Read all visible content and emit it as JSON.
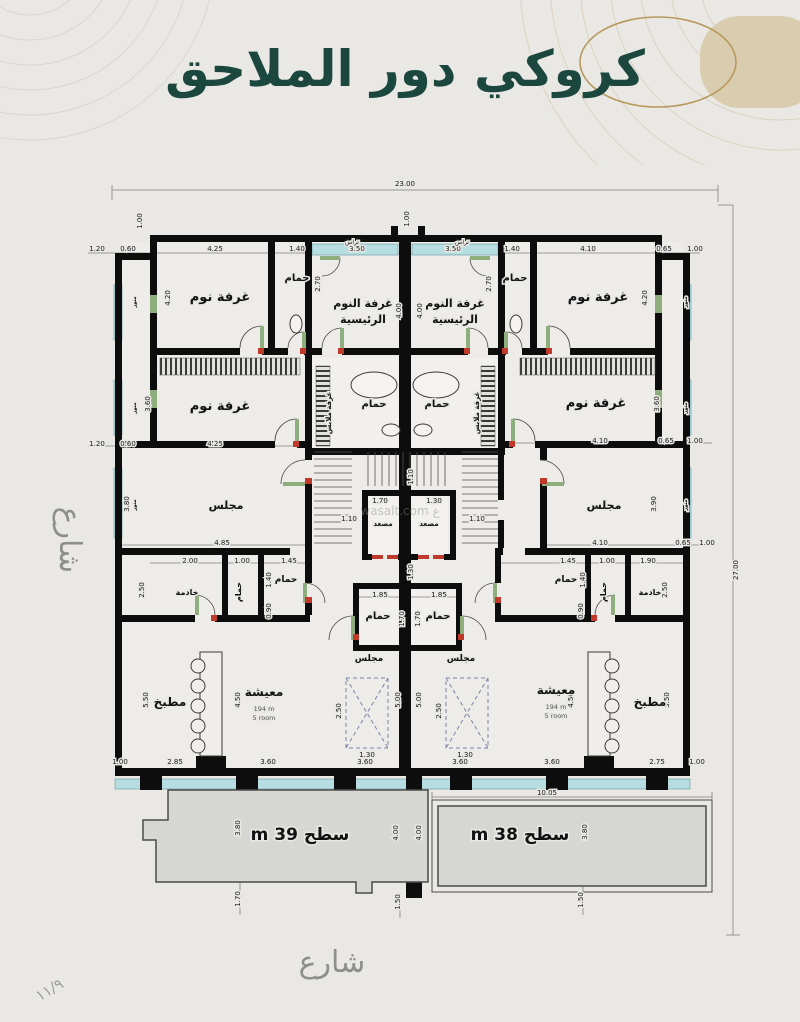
{
  "page": {
    "title": "كروكي دور الملاحق",
    "street_left": "شارع",
    "street_bottom": "شارع",
    "page_number": "١١/٩",
    "watermark": "wasalt.com ع"
  },
  "colors": {
    "title": "#1c473f",
    "gold": "#b8995c",
    "glazing": "#b7dde2",
    "wall": "#0d0d0d",
    "terrace_fill": "#d6d6d3",
    "street_text": "#8e8e8a",
    "door_mark": "#c0392b"
  },
  "plan": {
    "overall": {
      "width_m": "23.00",
      "height_m": "27.00"
    },
    "units": {
      "left_roof_label": "سطح 39 m",
      "right_roof_label": "سطح 38 m",
      "living_area": "194 m",
      "living_rooms": "5 room"
    },
    "labels": [
      {
        "n": "label-bedroom-1-left",
        "t": "غرفة نوم",
        "x": 220,
        "y": 301,
        "s": 13,
        "b": 1
      },
      {
        "n": "label-bath-top-left",
        "t": "حمام",
        "x": 297,
        "y": 281,
        "s": 10,
        "b": 1
      },
      {
        "n": "label-master-bedroom-left",
        "x": 363,
        "y": 307,
        "s": 11,
        "b": 1,
        "lines": [
          {
            "t": "غرفة النوم",
            "dy": 0
          },
          {
            "t": "الرئيسية",
            "dy": 16
          }
        ]
      },
      {
        "n": "label-master-bedroom-right",
        "x": 455,
        "y": 307,
        "s": 11,
        "b": 1,
        "lines": [
          {
            "t": "غرفة النوم",
            "dy": 0
          },
          {
            "t": "الرئيسية",
            "dy": 16
          }
        ]
      },
      {
        "n": "label-bath-top-right",
        "t": "حمام",
        "x": 515,
        "y": 281,
        "s": 10,
        "b": 1
      },
      {
        "n": "label-bedroom-1-right",
        "t": "غرفة نوم",
        "x": 598,
        "y": 301,
        "s": 13,
        "b": 1
      },
      {
        "n": "label-bedroom-2-left",
        "t": "غرفة نوم",
        "x": 220,
        "y": 410,
        "s": 13,
        "b": 1
      },
      {
        "n": "label-bedroom-2-right",
        "t": "غرفة نوم",
        "x": 596,
        "y": 407,
        "s": 13,
        "b": 1
      },
      {
        "n": "label-dressing-left",
        "t": "غرفة ملابس",
        "x": 331,
        "y": 413,
        "s": 7,
        "b": 1,
        "r": -90
      },
      {
        "n": "label-dressing-right",
        "t": "غرفة ملابس",
        "x": 479,
        "y": 413,
        "s": 7,
        "b": 1,
        "r": -90
      },
      {
        "n": "label-bath-mid-left",
        "t": "حمام",
        "x": 374,
        "y": 407,
        "s": 10,
        "b": 1
      },
      {
        "n": "label-bath-mid-right",
        "t": "حمام",
        "x": 437,
        "y": 407,
        "s": 10,
        "b": 1
      },
      {
        "n": "label-majlis-left",
        "t": "مجلس",
        "x": 226,
        "y": 509,
        "s": 11,
        "b": 1
      },
      {
        "n": "label-majlis-right",
        "t": "مجلس",
        "x": 604,
        "y": 509,
        "s": 11,
        "b": 1
      },
      {
        "n": "label-elevator-left",
        "t": "مصعد",
        "x": 383,
        "y": 526,
        "s": 7,
        "b": 1
      },
      {
        "n": "label-elevator-right",
        "t": "مصعد",
        "x": 429,
        "y": 526,
        "s": 7,
        "b": 1
      },
      {
        "n": "label-maid-left",
        "t": "خادمة",
        "x": 187,
        "y": 595,
        "s": 8,
        "b": 1
      },
      {
        "n": "label-bath-d1-left",
        "t": "حمام",
        "x": 241,
        "y": 592,
        "s": 8,
        "b": 1,
        "r": -90
      },
      {
        "n": "label-bath-d2-left",
        "t": "حمام",
        "x": 286,
        "y": 582,
        "s": 9,
        "b": 1
      },
      {
        "n": "label-bath-d1-right",
        "t": "حمام",
        "x": 566,
        "y": 582,
        "s": 9,
        "b": 1
      },
      {
        "n": "label-bath-d2-right",
        "t": "حمام",
        "x": 606,
        "y": 592,
        "s": 8,
        "b": 1,
        "r": -90
      },
      {
        "n": "label-maid-right",
        "t": "خادمة",
        "x": 650,
        "y": 595,
        "s": 8,
        "b": 1
      },
      {
        "n": "label-bath-center-left",
        "t": "حمام",
        "x": 378,
        "y": 619,
        "s": 10,
        "b": 1
      },
      {
        "n": "label-bath-center-right",
        "t": "حمام",
        "x": 438,
        "y": 619,
        "s": 10,
        "b": 1
      },
      {
        "n": "label-majlis-small-left",
        "t": "مجلس",
        "x": 369,
        "y": 661,
        "s": 9,
        "b": 1
      },
      {
        "n": "label-majlis-small-right",
        "t": "مجلس",
        "x": 461,
        "y": 661,
        "s": 9,
        "b": 1
      },
      {
        "n": "label-living-left",
        "x": 264,
        "y": 696,
        "s": 12,
        "b": 1,
        "lines": [
          {
            "t": "معيشة",
            "dy": 0
          },
          {
            "t": "194 m",
            "dy": 15,
            "s": 6.5,
            "b": 0,
            "c": "#555553"
          },
          {
            "t": "5 room",
            "dy": 24,
            "s": 6.5,
            "b": 0,
            "c": "#555553"
          }
        ]
      },
      {
        "n": "label-living-right",
        "x": 556,
        "y": 694,
        "s": 12,
        "b": 1,
        "lines": [
          {
            "t": "معيشة",
            "dy": 0
          },
          {
            "t": "194 m",
            "dy": 15,
            "s": 6.5,
            "b": 0,
            "c": "#555553"
          },
          {
            "t": "5 room",
            "dy": 24,
            "s": 6.5,
            "b": 0,
            "c": "#555553"
          }
        ]
      },
      {
        "n": "label-kitchen-left",
        "t": "مطبخ",
        "x": 170,
        "y": 706,
        "s": 12,
        "b": 1
      },
      {
        "n": "label-kitchen-right",
        "t": "مطبخ",
        "x": 650,
        "y": 706,
        "s": 12,
        "b": 1
      },
      {
        "n": "label-roof-left",
        "t": "سطح 39 m",
        "x": 300,
        "y": 840,
        "s": 17,
        "b": 1,
        "rtl": 1
      },
      {
        "n": "label-roof-right",
        "t": "سطح 38 m",
        "x": 520,
        "y": 840,
        "s": 17,
        "b": 1,
        "rtl": 1
      },
      {
        "n": "label-balcony-left",
        "t": "تراس",
        "x": 352,
        "y": 244,
        "s": 6
      },
      {
        "n": "label-balcony-right",
        "t": "تراس",
        "x": 462,
        "y": 244,
        "s": 6
      },
      {
        "n": "label-lightwell-left-1",
        "t": "منور",
        "x": 136,
        "y": 302,
        "s": 5,
        "b": 1,
        "r": -90
      },
      {
        "n": "label-lightwell-left-2",
        "t": "منور",
        "x": 136,
        "y": 408,
        "s": 5,
        "b": 1,
        "r": -90
      },
      {
        "n": "label-lightwell-left-3",
        "t": "منور",
        "x": 136,
        "y": 505,
        "s": 5,
        "b": 1,
        "r": -90
      },
      {
        "n": "label-lightwell-right-1",
        "t": "منور",
        "x": 687,
        "y": 302,
        "s": 5,
        "b": 1,
        "r": -90
      },
      {
        "n": "label-lightwell-right-2",
        "t": "منور",
        "x": 687,
        "y": 408,
        "s": 5,
        "b": 1,
        "r": -90
      },
      {
        "n": "label-lightwell-right-3",
        "t": "منور",
        "x": 687,
        "y": 505,
        "s": 5,
        "b": 1,
        "r": -90
      }
    ],
    "dims": [
      {
        "t": "23.00",
        "x": 405,
        "y": 186
      },
      {
        "t": "27.00",
        "x": 738,
        "y": 570,
        "r": 1
      },
      {
        "t": "1.20",
        "x": 97,
        "y": 251
      },
      {
        "t": "0.60",
        "x": 128,
        "y": 251
      },
      {
        "t": "4.25",
        "x": 215,
        "y": 251
      },
      {
        "t": "1.40",
        "x": 297,
        "y": 251
      },
      {
        "t": "3.50",
        "x": 357,
        "y": 251
      },
      {
        "t": "3.50",
        "x": 453,
        "y": 251
      },
      {
        "t": "1.40",
        "x": 512,
        "y": 251
      },
      {
        "t": "4.10",
        "x": 588,
        "y": 251
      },
      {
        "t": "0.65",
        "x": 664,
        "y": 251
      },
      {
        "t": "1.00",
        "x": 695,
        "y": 251
      },
      {
        "t": "1.00",
        "x": 409,
        "y": 219,
        "r": 1
      },
      {
        "t": "1.00",
        "x": 142,
        "y": 221,
        "r": 1
      },
      {
        "t": "4.20",
        "x": 170,
        "y": 298,
        "r": 1
      },
      {
        "t": "2.70",
        "x": 320,
        "y": 284,
        "r": 1
      },
      {
        "t": "4.00",
        "x": 401,
        "y": 311,
        "r": 1
      },
      {
        "t": "4.00",
        "x": 422,
        "y": 311,
        "r": 1
      },
      {
        "t": "2.70",
        "x": 491,
        "y": 284,
        "r": 1
      },
      {
        "t": "4.20",
        "x": 647,
        "y": 298,
        "r": 1
      },
      {
        "t": "3.60",
        "x": 150,
        "y": 404,
        "r": 1
      },
      {
        "t": "3.60",
        "x": 659,
        "y": 404,
        "r": 1
      },
      {
        "t": "1.20",
        "x": 97,
        "y": 446
      },
      {
        "t": "0.60",
        "x": 128,
        "y": 446
      },
      {
        "t": "4.25",
        "x": 215,
        "y": 446
      },
      {
        "t": "4.10",
        "x": 600,
        "y": 443
      },
      {
        "t": "0.65",
        "x": 666,
        "y": 443
      },
      {
        "t": "1.00",
        "x": 695,
        "y": 443
      },
      {
        "t": "4.85",
        "x": 222,
        "y": 545
      },
      {
        "t": "4.10",
        "x": 600,
        "y": 545
      },
      {
        "t": "0.65",
        "x": 683,
        "y": 545
      },
      {
        "t": "1.00",
        "x": 707,
        "y": 545
      },
      {
        "t": "3.80",
        "x": 129,
        "y": 504,
        "r": 1
      },
      {
        "t": "3.90",
        "x": 656,
        "y": 504,
        "r": 1
      },
      {
        "t": "1.70",
        "x": 380,
        "y": 503
      },
      {
        "t": "1.30",
        "x": 434,
        "y": 503
      },
      {
        "t": "1.10",
        "x": 349,
        "y": 521
      },
      {
        "t": "1.10",
        "x": 477,
        "y": 521
      },
      {
        "t": "1.10",
        "x": 413,
        "y": 477,
        "r": 1
      },
      {
        "t": "2.00",
        "x": 190,
        "y": 563
      },
      {
        "t": "1.00",
        "x": 242,
        "y": 563
      },
      {
        "t": "1.45",
        "x": 289,
        "y": 563
      },
      {
        "t": "1.45",
        "x": 568,
        "y": 563
      },
      {
        "t": "1.00",
        "x": 607,
        "y": 563
      },
      {
        "t": "1.90",
        "x": 648,
        "y": 563
      },
      {
        "t": "2.50",
        "x": 144,
        "y": 590,
        "r": 1
      },
      {
        "t": "1.40",
        "x": 271,
        "y": 580,
        "r": 1
      },
      {
        "t": "0.90",
        "x": 271,
        "y": 611,
        "r": 1
      },
      {
        "t": "1.40",
        "x": 585,
        "y": 580,
        "r": 1
      },
      {
        "t": "0.90",
        "x": 583,
        "y": 611,
        "r": 1
      },
      {
        "t": "2.50",
        "x": 667,
        "y": 590,
        "r": 1
      },
      {
        "t": "1.30",
        "x": 413,
        "y": 572,
        "r": 1
      },
      {
        "t": "1.85",
        "x": 380,
        "y": 597
      },
      {
        "t": "1.85",
        "x": 439,
        "y": 597
      },
      {
        "t": "1.70",
        "x": 404,
        "y": 619,
        "r": 1
      },
      {
        "t": "1.70",
        "x": 420,
        "y": 619,
        "r": 1
      },
      {
        "t": "2.50",
        "x": 341,
        "y": 711,
        "r": 1
      },
      {
        "t": "1.30",
        "x": 367,
        "y": 757
      },
      {
        "t": "2.50",
        "x": 441,
        "y": 711,
        "r": 1
      },
      {
        "t": "1.30",
        "x": 465,
        "y": 757
      },
      {
        "t": "5.00",
        "x": 400,
        "y": 700,
        "r": 1
      },
      {
        "t": "5.00",
        "x": 421,
        "y": 700,
        "r": 1
      },
      {
        "t": "5.50",
        "x": 148,
        "y": 700,
        "r": 1
      },
      {
        "t": "4.50",
        "x": 240,
        "y": 700,
        "r": 1
      },
      {
        "t": "4.50",
        "x": 573,
        "y": 700,
        "r": 1
      },
      {
        "t": "5.50",
        "x": 669,
        "y": 700,
        "r": 1
      },
      {
        "t": "1.00",
        "x": 120,
        "y": 764
      },
      {
        "t": "2.85",
        "x": 175,
        "y": 764
      },
      {
        "t": "3.60",
        "x": 268,
        "y": 764
      },
      {
        "t": "3.60",
        "x": 365,
        "y": 764
      },
      {
        "t": "3.60",
        "x": 460,
        "y": 764
      },
      {
        "t": "3.60",
        "x": 552,
        "y": 764
      },
      {
        "t": "2.75",
        "x": 657,
        "y": 764
      },
      {
        "t": "1.00",
        "x": 697,
        "y": 764
      },
      {
        "t": "10.05",
        "x": 547,
        "y": 795
      },
      {
        "t": "3.80",
        "x": 240,
        "y": 828,
        "r": 1
      },
      {
        "t": "4.00",
        "x": 398,
        "y": 833,
        "r": 1
      },
      {
        "t": "4.00",
        "x": 421,
        "y": 833,
        "r": 1
      },
      {
        "t": "3.80",
        "x": 587,
        "y": 832,
        "r": 1
      },
      {
        "t": "1.70",
        "x": 240,
        "y": 899,
        "r": 1
      },
      {
        "t": "1.50",
        "x": 400,
        "y": 902,
        "r": 1
      },
      {
        "t": "1.50",
        "x": 583,
        "y": 900,
        "r": 1
      }
    ]
  }
}
